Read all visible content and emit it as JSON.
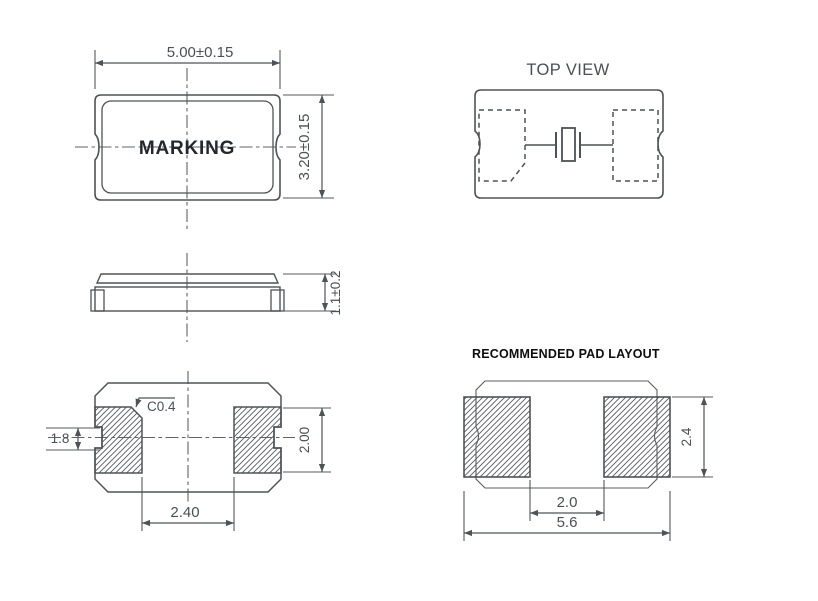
{
  "drawing": {
    "views": {
      "front": {
        "marking_label": "MARKING",
        "dim_width": "5.00±0.15",
        "dim_height": "3.20±0.15"
      },
      "top": {
        "title": "TOP VIEW"
      },
      "side": {
        "dim_thickness": "1.1±0.2"
      },
      "bottom": {
        "dim_chamfer": "C0.4",
        "dim_notch_span": "1.8",
        "dim_pad_height": "2.00",
        "dim_pad_gap": "2.40"
      },
      "pad_layout": {
        "title": "RECOMMENDED PAD LAYOUT",
        "dim_pad_gap": "2.0",
        "dim_total_width": "5.6",
        "dim_pad_height": "2.4"
      }
    },
    "colors": {
      "line": "#4e5357",
      "dimension_text": "#4b5057",
      "marking_text": "#24272d",
      "top_view_title": "#4a4f56",
      "pad_layout_title": "#0d0d0d",
      "background": "#ffffff"
    }
  }
}
